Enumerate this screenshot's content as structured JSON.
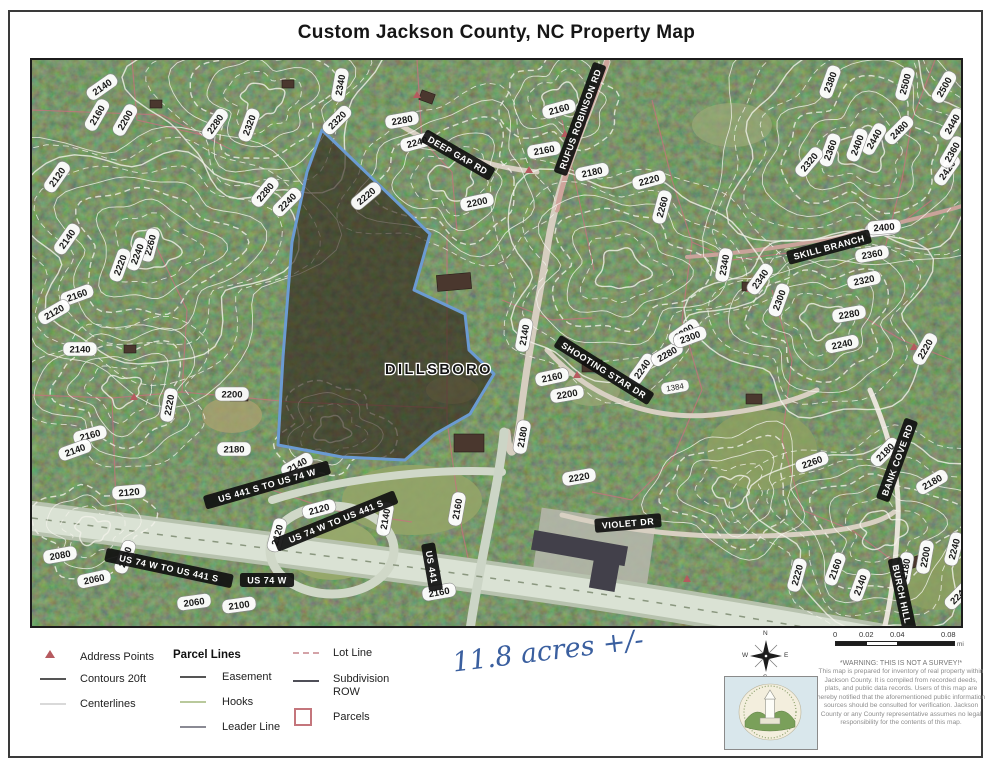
{
  "title": "Custom Jackson County, NC Property Map",
  "map": {
    "place_label": "DILLSBORO",
    "place_pos": {
      "x": 437,
      "y": 372
    },
    "house_number": {
      "text": "1384",
      "x": 673,
      "y": 385
    },
    "parcel": {
      "stroke": "#6b9bd2",
      "fill": "rgba(45,33,22,0.62)",
      "points": [
        [
          320,
          128
        ],
        [
          428,
          232
        ],
        [
          412,
          288
        ],
        [
          463,
          312
        ],
        [
          467,
          348
        ],
        [
          492,
          372
        ],
        [
          468,
          412
        ],
        [
          433,
          432
        ],
        [
          403,
          458
        ],
        [
          340,
          455
        ],
        [
          276,
          443
        ],
        [
          281,
          355
        ],
        [
          290,
          240
        ],
        [
          305,
          170
        ]
      ]
    },
    "road_labels": [
      [
        "DEEP GAP RD",
        456,
        153,
        30
      ],
      [
        "RUFUS ROBINSON RD",
        578,
        117,
        -70
      ],
      [
        "SKILL BRANCH",
        827,
        245,
        -15
      ],
      [
        "SHOOTING STAR DR",
        602,
        368,
        32
      ],
      [
        "VIOLET DR",
        626,
        521,
        -5
      ],
      [
        "BANK COVE RD",
        895,
        458,
        -70
      ],
      [
        "BURCH HILL",
        900,
        592,
        78
      ],
      [
        "US 441 S TO US 74 W",
        265,
        483,
        -16
      ],
      [
        "US 74 W TO US 441 S",
        334,
        519,
        -22
      ],
      [
        "US 74 W TO US 441 S",
        167,
        566,
        12
      ],
      [
        "US 74 W",
        265,
        578,
        0
      ],
      [
        "US 441",
        430,
        565,
        80
      ]
    ],
    "contour_labels": [
      [
        "2140",
        100,
        85,
        -35
      ],
      [
        "2160",
        95,
        113,
        -60
      ],
      [
        "2200",
        123,
        118,
        -60
      ],
      [
        "2280",
        213,
        122,
        -55
      ],
      [
        "2320",
        247,
        123,
        -70
      ],
      [
        "2340",
        338,
        83,
        -80
      ],
      [
        "2320",
        335,
        118,
        -45
      ],
      [
        "2280",
        400,
        118,
        -10
      ],
      [
        "2240",
        415,
        140,
        -15
      ],
      [
        "2160",
        557,
        107,
        -15
      ],
      [
        "2160",
        542,
        148,
        -10
      ],
      [
        "2180",
        590,
        170,
        -12
      ],
      [
        "2220",
        647,
        178,
        -15
      ],
      [
        "2260",
        660,
        205,
        -75
      ],
      [
        "2200",
        475,
        200,
        -12
      ],
      [
        "2280",
        263,
        190,
        -50
      ],
      [
        "2240",
        285,
        200,
        -45
      ],
      [
        "2220",
        364,
        194,
        -40
      ],
      [
        "2120",
        55,
        175,
        -55
      ],
      [
        "2140",
        65,
        237,
        -55
      ],
      [
        "2160",
        75,
        293,
        -20
      ],
      [
        "2120",
        52,
        310,
        -30
      ],
      [
        "2140",
        78,
        347,
        0
      ],
      [
        "2260",
        148,
        243,
        -75
      ],
      [
        "2240",
        135,
        252,
        -70
      ],
      [
        "2220",
        118,
        263,
        -70
      ],
      [
        "2220",
        167,
        403,
        -80
      ],
      [
        "2200",
        230,
        392,
        0
      ],
      [
        "2180",
        232,
        447,
        0
      ],
      [
        "2160",
        88,
        433,
        -15
      ],
      [
        "2140",
        73,
        448,
        -20
      ],
      [
        "2080",
        58,
        553,
        -10
      ],
      [
        "2060",
        92,
        577,
        -12
      ],
      [
        "2120",
        127,
        490,
        -5
      ],
      [
        "2100",
        123,
        555,
        -70
      ],
      [
        "2060",
        192,
        600,
        -8
      ],
      [
        "2100",
        237,
        603,
        -8
      ],
      [
        "2140",
        295,
        463,
        -30
      ],
      [
        "2120",
        275,
        533,
        -75
      ],
      [
        "2120",
        317,
        507,
        -15
      ],
      [
        "2140",
        383,
        517,
        -80
      ],
      [
        "2160",
        455,
        507,
        -80
      ],
      [
        "2160",
        437,
        590,
        -10
      ],
      [
        "2140",
        522,
        333,
        -80
      ],
      [
        "2160",
        550,
        375,
        -12
      ],
      [
        "2200",
        565,
        392,
        -10
      ],
      [
        "2180",
        520,
        435,
        -80
      ],
      [
        "2240",
        640,
        367,
        -55
      ],
      [
        "2280",
        665,
        352,
        -30
      ],
      [
        "2300",
        682,
        330,
        -35
      ],
      [
        "2220",
        577,
        475,
        -10
      ],
      [
        "2400",
        880,
        227,
        -8
      ],
      [
        "2360",
        870,
        252,
        -10
      ],
      [
        "2320",
        862,
        278,
        -12
      ],
      [
        "2340",
        722,
        263,
        -80
      ],
      [
        "2340",
        758,
        277,
        -55
      ],
      [
        "2300",
        777,
        298,
        -70
      ],
      [
        "2280",
        847,
        312,
        -10
      ],
      [
        "2240",
        840,
        342,
        -12
      ],
      [
        "2300",
        688,
        335,
        -20
      ],
      [
        "2220",
        923,
        347,
        -60
      ],
      [
        "2380",
        828,
        80,
        -70
      ],
      [
        "2500",
        903,
        82,
        -75
      ],
      [
        "2500",
        942,
        85,
        -60
      ],
      [
        "2480",
        897,
        128,
        -45
      ],
      [
        "2440",
        872,
        137,
        -60
      ],
      [
        "2400",
        855,
        143,
        -70
      ],
      [
        "2360",
        828,
        148,
        -70
      ],
      [
        "2320",
        807,
        160,
        -50
      ],
      [
        "2420",
        945,
        168,
        -55
      ],
      [
        "2400",
        882,
        225,
        -5
      ],
      [
        "2440",
        950,
        122,
        -60
      ],
      [
        "2360",
        950,
        150,
        -60
      ],
      [
        "2260",
        810,
        460,
        -20
      ],
      [
        "2220",
        795,
        573,
        -75
      ],
      [
        "2160",
        833,
        567,
        -70
      ],
      [
        "2140",
        858,
        583,
        -70
      ],
      [
        "2180",
        930,
        480,
        -30
      ],
      [
        "2180",
        903,
        567,
        -80
      ],
      [
        "2200",
        923,
        555,
        -80
      ],
      [
        "2240",
        952,
        547,
        -75
      ],
      [
        "2240",
        957,
        593,
        -45
      ],
      [
        "2180",
        883,
        450,
        -45
      ]
    ],
    "address_points": [
      {
        "x": 527,
        "y": 168
      },
      {
        "x": 575,
        "y": 373
      },
      {
        "x": 132,
        "y": 395
      },
      {
        "x": 685,
        "y": 577
      },
      {
        "x": 748,
        "y": 287
      },
      {
        "x": 912,
        "y": 345
      },
      {
        "x": 563,
        "y": 132
      },
      {
        "x": 235,
        "y": 388
      },
      {
        "x": 415,
        "y": 93
      }
    ],
    "annotation": "11.8 acres +/-"
  },
  "legend": {
    "address_points": "Address Points",
    "contours": "Contours 20ft",
    "centerlines": "Centerlines",
    "parcel_lines_header": "Parcel Lines",
    "easement": "Easement",
    "hooks": "Hooks",
    "leader_line": "Leader Line",
    "lot_line": "Lot Line",
    "subdivision_row": "Subdivision ROW",
    "parcels": "Parcels"
  },
  "compass": {
    "n": "N",
    "e": "E",
    "s": "S",
    "w": "W"
  },
  "scalebar": {
    "ticks": [
      "0",
      "0.02",
      "0.04",
      "0.08"
    ],
    "unit": "mi"
  },
  "disclaimer": {
    "headline": "*WARNING: THIS IS NOT A SURVEY!*",
    "body": "This map is prepared for inventory of real property within Jackson County. It is compiled from recorded deeds, plats, and public data records. Users of this map are hereby notified that the aforementioned public information sources should be consulted for verification. Jackson County or any County representative assumes no legal responsibility for the contents of this map."
  },
  "colors": {
    "parcel_outline": "#6b9bd2",
    "parcel_fill": "rgba(45,33,22,0.62)",
    "contour_line": "#f3f3ea",
    "parcel_line_pink": "#c4737e",
    "road_label_bg": "#101010",
    "annotation_ink": "#3a5f9f",
    "address_point": "#b65a5f"
  }
}
